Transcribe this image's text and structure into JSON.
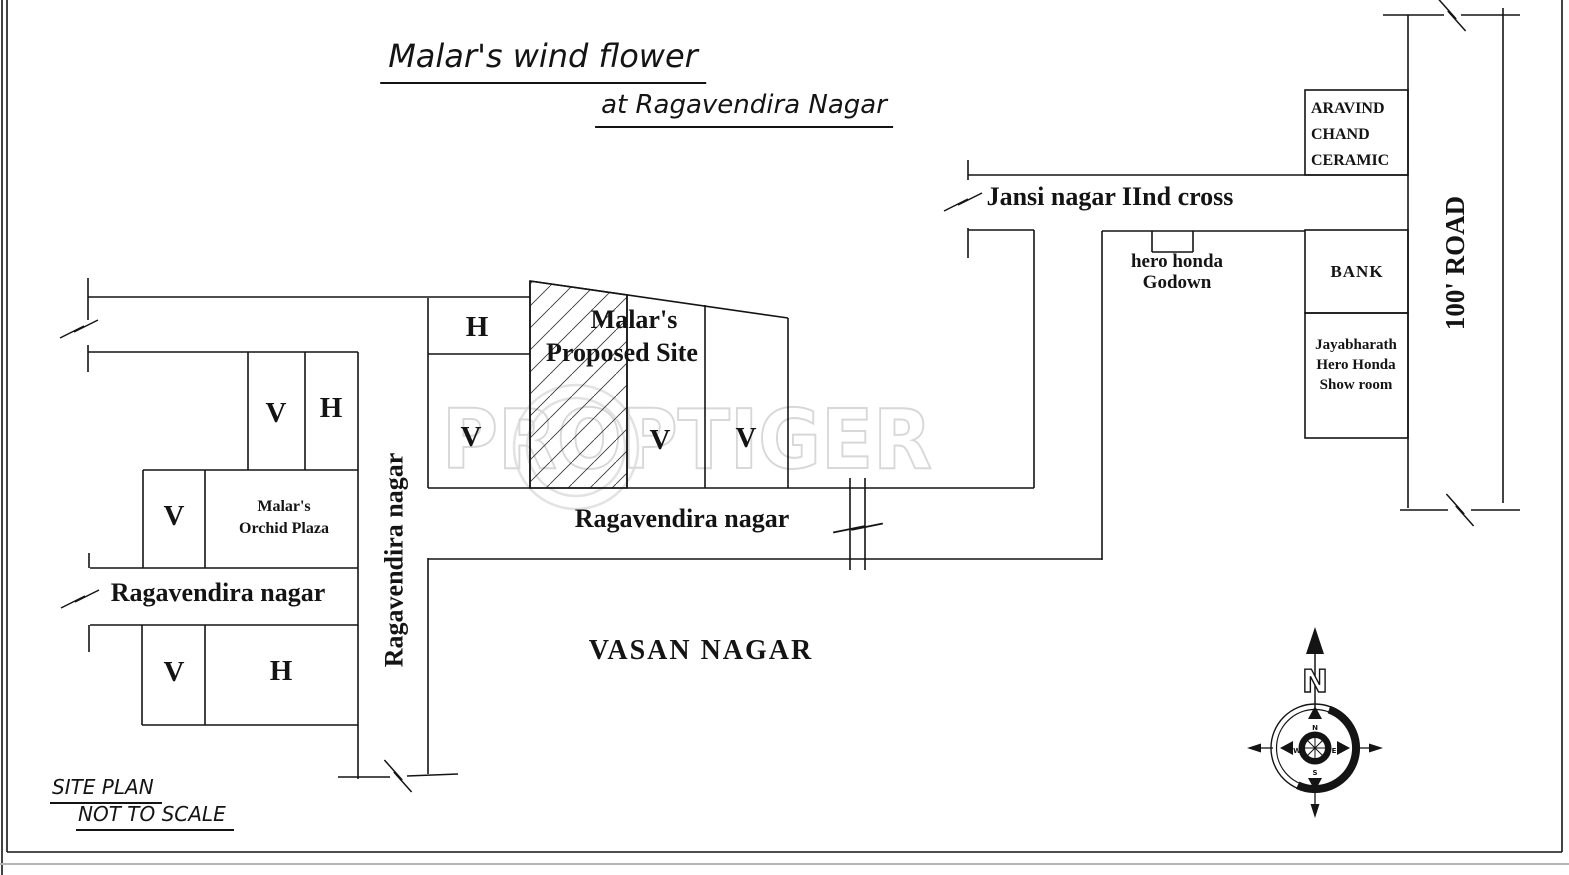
{
  "page": {
    "title_main": "Malar's wind flower",
    "title_sub": "at Ragavendira Nagar"
  },
  "watermark": {
    "text": "PROPTIGER"
  },
  "roads": {
    "jansi": "Jansi nagar IInd cross",
    "ragavendira_mid": "Ragavendira nagar",
    "ragavendira_left": "Ragavendira nagar",
    "ragavendira_vertical": "Ragavendira nagar",
    "road_100": "100' ROAD"
  },
  "areas": {
    "vasan": "VASAN NAGAR"
  },
  "buildings": {
    "aravind_1": "ARAVIND",
    "aravind_2": "CHAND",
    "aravind_3": "CERAMIC",
    "bank": "BANK",
    "jaya_1": "Jayabharath",
    "jaya_2": "Hero Honda",
    "jaya_3": "Show room",
    "godown_1": "hero honda",
    "godown_2": "Godown",
    "orchid_1": "Malar's",
    "orchid_2": "Orchid Plaza",
    "site_1": "Malar's",
    "site_2": "Proposed Site"
  },
  "plots": {
    "central_h": "H",
    "central_v1": "V",
    "central_v2": "V",
    "central_v3": "V",
    "left_v": "V",
    "left_h": "H",
    "orchid_v": "V",
    "bottom_v": "V",
    "bottom_h": "H"
  },
  "footer": {
    "site_plan": "SITE PLAN",
    "not_to_scale": "NOT TO SCALE"
  },
  "compass": {
    "north": "N",
    "n": "N",
    "e": "E",
    "s": "S",
    "w": "W"
  }
}
